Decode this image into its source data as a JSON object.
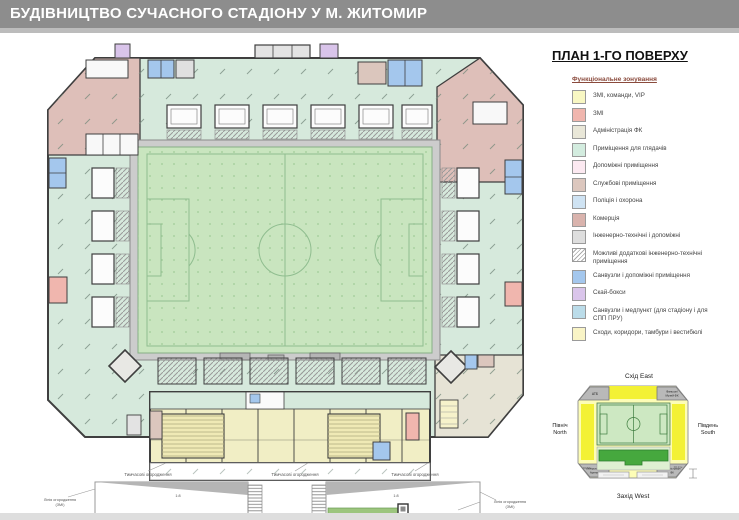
{
  "header": {
    "title": "БУДІВНИЦТВО СУЧАСНОГО СТАДІОНУ У М. ЖИТОМИР"
  },
  "panel": {
    "title": "ПЛАН 1-ГО ПОВЕРХУ",
    "legend_title": "Функціональне зонування",
    "legend": [
      {
        "label": "ЗМІ, команди, VIP",
        "color": "#f8f7c3"
      },
      {
        "label": "ЗМІ",
        "color": "#f0b6ae"
      },
      {
        "label": "Адміністрація ФК",
        "color": "#e9e7d8"
      },
      {
        "label": "Приміщення для глядачів",
        "color": "#d3ecdf"
      },
      {
        "label": "Допоміжні приміщення",
        "color": "#fce9f1"
      },
      {
        "label": "Службові приміщення",
        "color": "#dcc7be"
      },
      {
        "label": "Поліція і охорона",
        "color": "#cfe3f3"
      },
      {
        "label": "Комерція",
        "color": "#d9b3ad"
      },
      {
        "label": "Інженерно-технічні і допоміжні",
        "color": "#dedede"
      },
      {
        "label": "Можливі додаткові інженерно-технічні приміщення",
        "color": "hatch"
      },
      {
        "label": "Санвузли і допоміжні приміщення",
        "color": "#a4c7ed"
      },
      {
        "label": "Скай-бокси",
        "color": "#dac5eb"
      },
      {
        "label": "Санвузли і медпункт (для стадіону і для СПП ПРУ)",
        "color": "#bbdce9"
      },
      {
        "label": "Сходи, коридори, тамбури і вестибюлі",
        "color": "#f9f4c6"
      }
    ]
  },
  "minimap": {
    "east": "Схід East",
    "west": "Захід West",
    "north_1": "Північ",
    "north_2": "North",
    "south_1": "Південь",
    "south_2": "South",
    "corner_nw": "АТБ",
    "corner_ne_1": "Фаншоп/",
    "corner_ne_2": "Музей ФК",
    "corner_sw_1": "Кіберспорт-",
    "corner_sw_2": "Арена",
    "corner_se_1": "Адміністрація",
    "corner_se_2": "ФК",
    "level_left": "±0,0 м",
    "level_right": "±0,0 м"
  },
  "plan": {
    "annotations": {
      "temp_fence": "Тимчасові огородження",
      "line_left_1": "Лінія огородження",
      "line_left_2": "(ЗМІ)",
      "line_right_1": "Лінія огородження",
      "line_right_2": "(ЗМІ)",
      "ramp_note": "Об'єм рампи для заїзду",
      "slope": "1:8"
    }
  }
}
